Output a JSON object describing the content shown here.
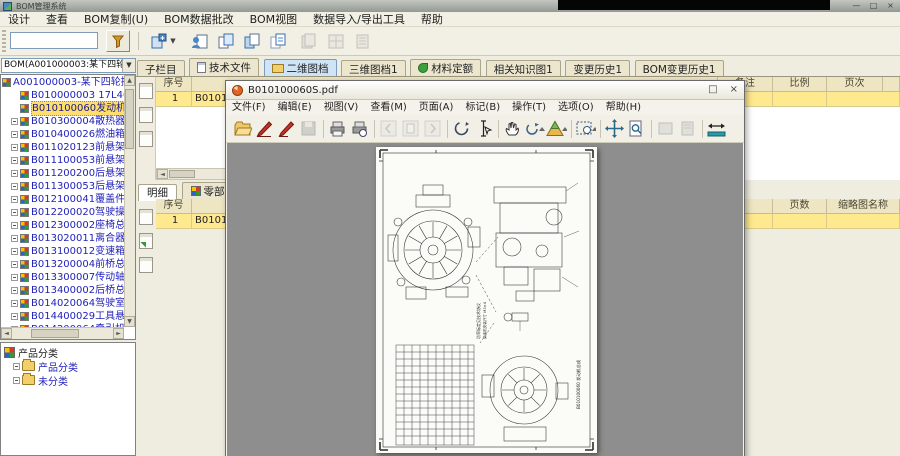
{
  "window": {
    "title": "BOM管理系统",
    "min": "—",
    "max": "□",
    "close": "×"
  },
  "menu": {
    "items": [
      "设计",
      "查看",
      "BOM复制(U)",
      "BOM数据批改",
      "BOM视图",
      "数据导入/导出工具",
      "帮助"
    ]
  },
  "toolbar": {
    "search_value": "",
    "caret": "▼",
    "icons": [
      "filter-funnel-icon",
      "bom-new-dropdown-icon",
      "copy-node-icon",
      "copy-page-icon",
      "copy-pages-icon",
      "copy-branch-icon",
      "paste-disabled-icon",
      "report-disabled-icon",
      "export-disabled-icon"
    ]
  },
  "left": {
    "bom_combo": {
      "value": "BOM(A001000003:某下四轮拖…",
      "caret": "▼"
    },
    "tree": {
      "root": "A001000003-某下四轮拖拉机总成-(1",
      "items": [
        {
          "label": "B010000003 17L40底盘总成1",
          "toggle": false,
          "selected": false
        },
        {
          "label": "B010100060发动机总成 1",
          "toggle": false,
          "selected": true
        },
        {
          "label": "B010300004散热器总成 1",
          "toggle": true,
          "selected": false
        },
        {
          "label": "B010400026燃油箱总成 1",
          "toggle": true,
          "selected": false
        },
        {
          "label": "B011020123前悬架 1",
          "toggle": true,
          "selected": false
        },
        {
          "label": "B011100053前悬架附件-1",
          "toggle": true,
          "selected": false
        },
        {
          "label": "B011200200后悬架 1",
          "toggle": true,
          "selected": false
        },
        {
          "label": "B011300053后悬架附件-1",
          "toggle": true,
          "selected": false
        },
        {
          "label": "B012100041覆盖件附件-1",
          "toggle": true,
          "selected": false
        },
        {
          "label": "B012200020驾驶操纵总成 1",
          "toggle": true,
          "selected": false
        },
        {
          "label": "B012300002座椅总成 1",
          "toggle": true,
          "selected": false
        },
        {
          "label": "B013020011离合器总成 1",
          "toggle": true,
          "selected": false
        },
        {
          "label": "B013100012变速箱总成 1",
          "toggle": true,
          "selected": false
        },
        {
          "label": "B013200004前桥总成 1",
          "toggle": true,
          "selected": false
        },
        {
          "label": "B013300007传动轴总成 1",
          "toggle": true,
          "selected": false
        },
        {
          "label": "B013400002后桥总成 1",
          "toggle": true,
          "selected": false
        },
        {
          "label": "B014020064驾驶室总成 1",
          "toggle": true,
          "selected": false
        },
        {
          "label": "B014400029工具悬置附件1",
          "toggle": true,
          "selected": false
        },
        {
          "label": "B014200064牵引机构 1",
          "toggle": true,
          "selected": false
        },
        {
          "label": "B015020021燃油管路总成1",
          "toggle": true,
          "selected": false
        }
      ]
    },
    "category": {
      "root": "产品分类",
      "folders": [
        {
          "label": "产品分类"
        },
        {
          "label": "未分类"
        }
      ]
    }
  },
  "main": {
    "tabs": [
      {
        "label": "子栏目",
        "icon": "",
        "selected": false
      },
      {
        "label": "技术文件",
        "icon": "doc",
        "selected": false
      },
      {
        "label": "二维图档",
        "icon": "folder",
        "selected": true
      },
      {
        "label": "三维图档1",
        "icon": "",
        "selected": false
      },
      {
        "label": "材料定额",
        "icon": "leaf",
        "selected": false
      },
      {
        "label": "相关知识图1",
        "icon": "",
        "selected": false
      },
      {
        "label": "变更历史1",
        "icon": "",
        "selected": false
      },
      {
        "label": "BOM变更历史1",
        "icon": "",
        "selected": false
      }
    ],
    "upper_table": {
      "headers": [
        {
          "label": "序号"
        },
        {
          "label": ""
        },
        {
          "label": "备注"
        },
        {
          "label": "比例"
        },
        {
          "label": "页次"
        }
      ],
      "row": {
        "seq": "1",
        "code": "B010100060"
      }
    },
    "lower": {
      "tabs": [
        {
          "label": "明细",
          "icon": "",
          "selected": true
        },
        {
          "label": "零部件",
          "icon": "bom",
          "selected": false
        }
      ],
      "headers": [
        {
          "label": "序号"
        },
        {
          "label": ""
        },
        {
          "label": "页数"
        },
        {
          "label": "缩略图名称"
        }
      ],
      "row": {
        "seq": "1",
        "code": "B010100060"
      }
    }
  },
  "pdf": {
    "title": "B010100060S.pdf",
    "buttons": {
      "max": "□",
      "close": "×"
    },
    "menu": [
      "文件(F)",
      "编辑(E)",
      "视图(V)",
      "查看(M)",
      "页面(A)",
      "标记(B)",
      "操作(T)",
      "选项(O)",
      "帮助(H)"
    ],
    "toolbar_icons": [
      "open-folder-icon",
      "sign-pen-icon",
      "sign-pen-alt-icon",
      "save-disabled-icon",
      "print-icon",
      "print-preview-icon",
      "page-prev-disabled-icon",
      "page-current-disabled-icon",
      "page-next-disabled-icon",
      "rotate-view-icon",
      "text-select-icon",
      "hand-tool-icon",
      "rotate-90-icon",
      "measure-prism-icon",
      "select-zoom-icon",
      "fit-page-icon",
      "zoom-preview-icon",
      "stamp-disabled-icon",
      "attach-disabled-icon",
      "fit-width-icon"
    ]
  }
}
